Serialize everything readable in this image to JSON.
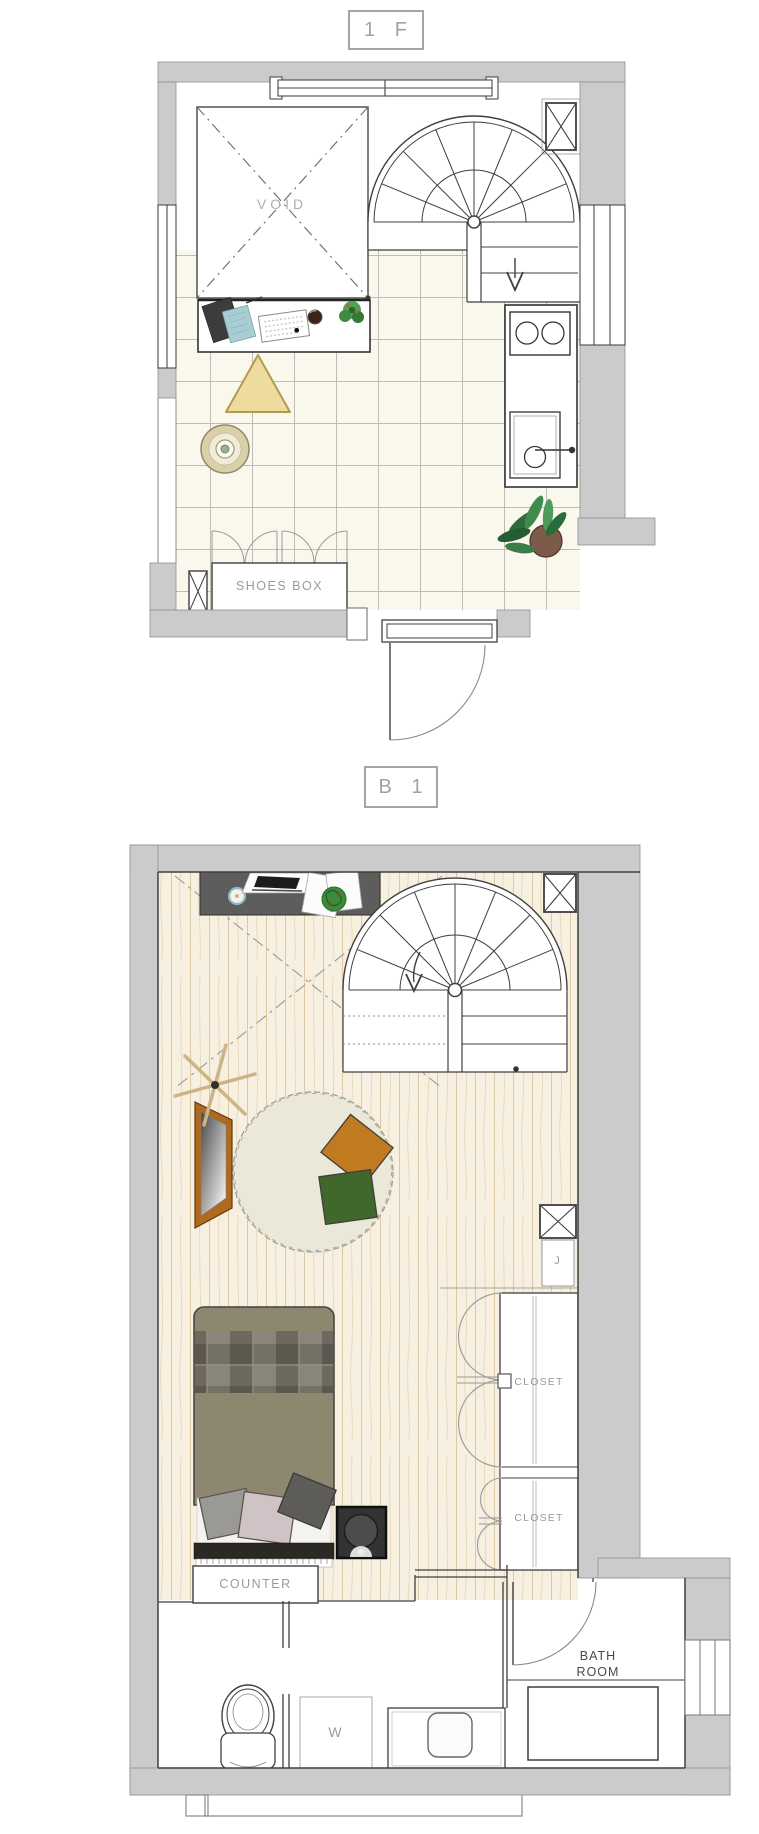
{
  "floor1": {
    "title": "1 F",
    "void_label": "VOID",
    "shoes_box_label": "SHOES BOX"
  },
  "basement": {
    "title": "B 1",
    "j_label": "J",
    "closet_upper_label": "CLOSET",
    "closet_lower_label": "CLOSET",
    "counter_label": "COUNTER",
    "washer_label": "W",
    "bath_label_line1": "BATH",
    "bath_label_line2": "ROOM"
  },
  "colors": {
    "wall_fill": "#cbcbcb",
    "line_dark": "#3f3f3f",
    "label_gray": "#9b9b9b",
    "tile_floor": "#faf7ec",
    "tile_grout": "#bdbdb3",
    "wood_floor": "#f7efe0",
    "wood_grain": "#dbc9a9",
    "desk_dark": "#5d5d5c",
    "rug": "#ebe8da",
    "cushion_orange": "#c07a20",
    "cushion_green": "#41682c",
    "mirror_frame": "#b06a20",
    "bed_base": "#8d8770",
    "triangle_cushion": "#eedc9f",
    "stool": "#d9cfa8",
    "plant_green": "#2f6b3f"
  }
}
